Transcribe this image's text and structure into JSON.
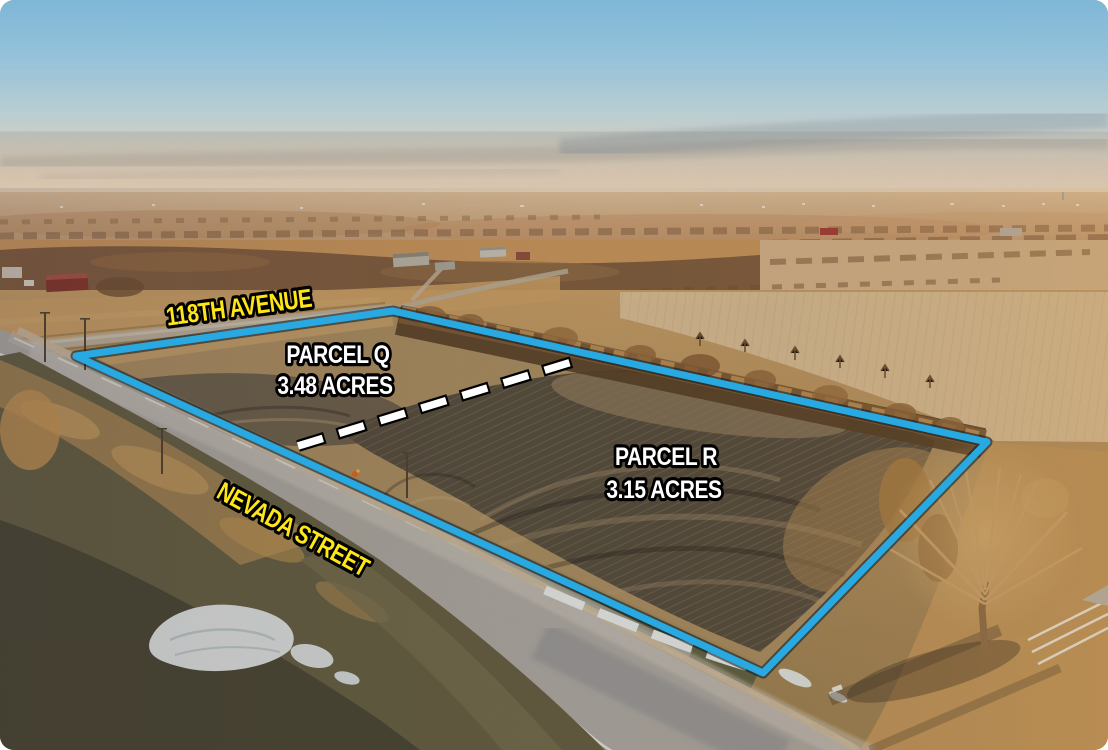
{
  "annotations": {
    "street_top": "118TH AVENUE",
    "street_bottom": "NEVADA STREET",
    "parcels": [
      {
        "name": "PARCEL Q",
        "area": "3.48 ACRES"
      },
      {
        "name": "PARCEL R",
        "area": "3.15 ACRES"
      }
    ]
  },
  "colors": {
    "boundary_line": "#29a9e1",
    "street_label": "#ffe616",
    "parcel_label": "#ffffff",
    "divider_line": "#ffffff",
    "label_outline": "#000000"
  }
}
